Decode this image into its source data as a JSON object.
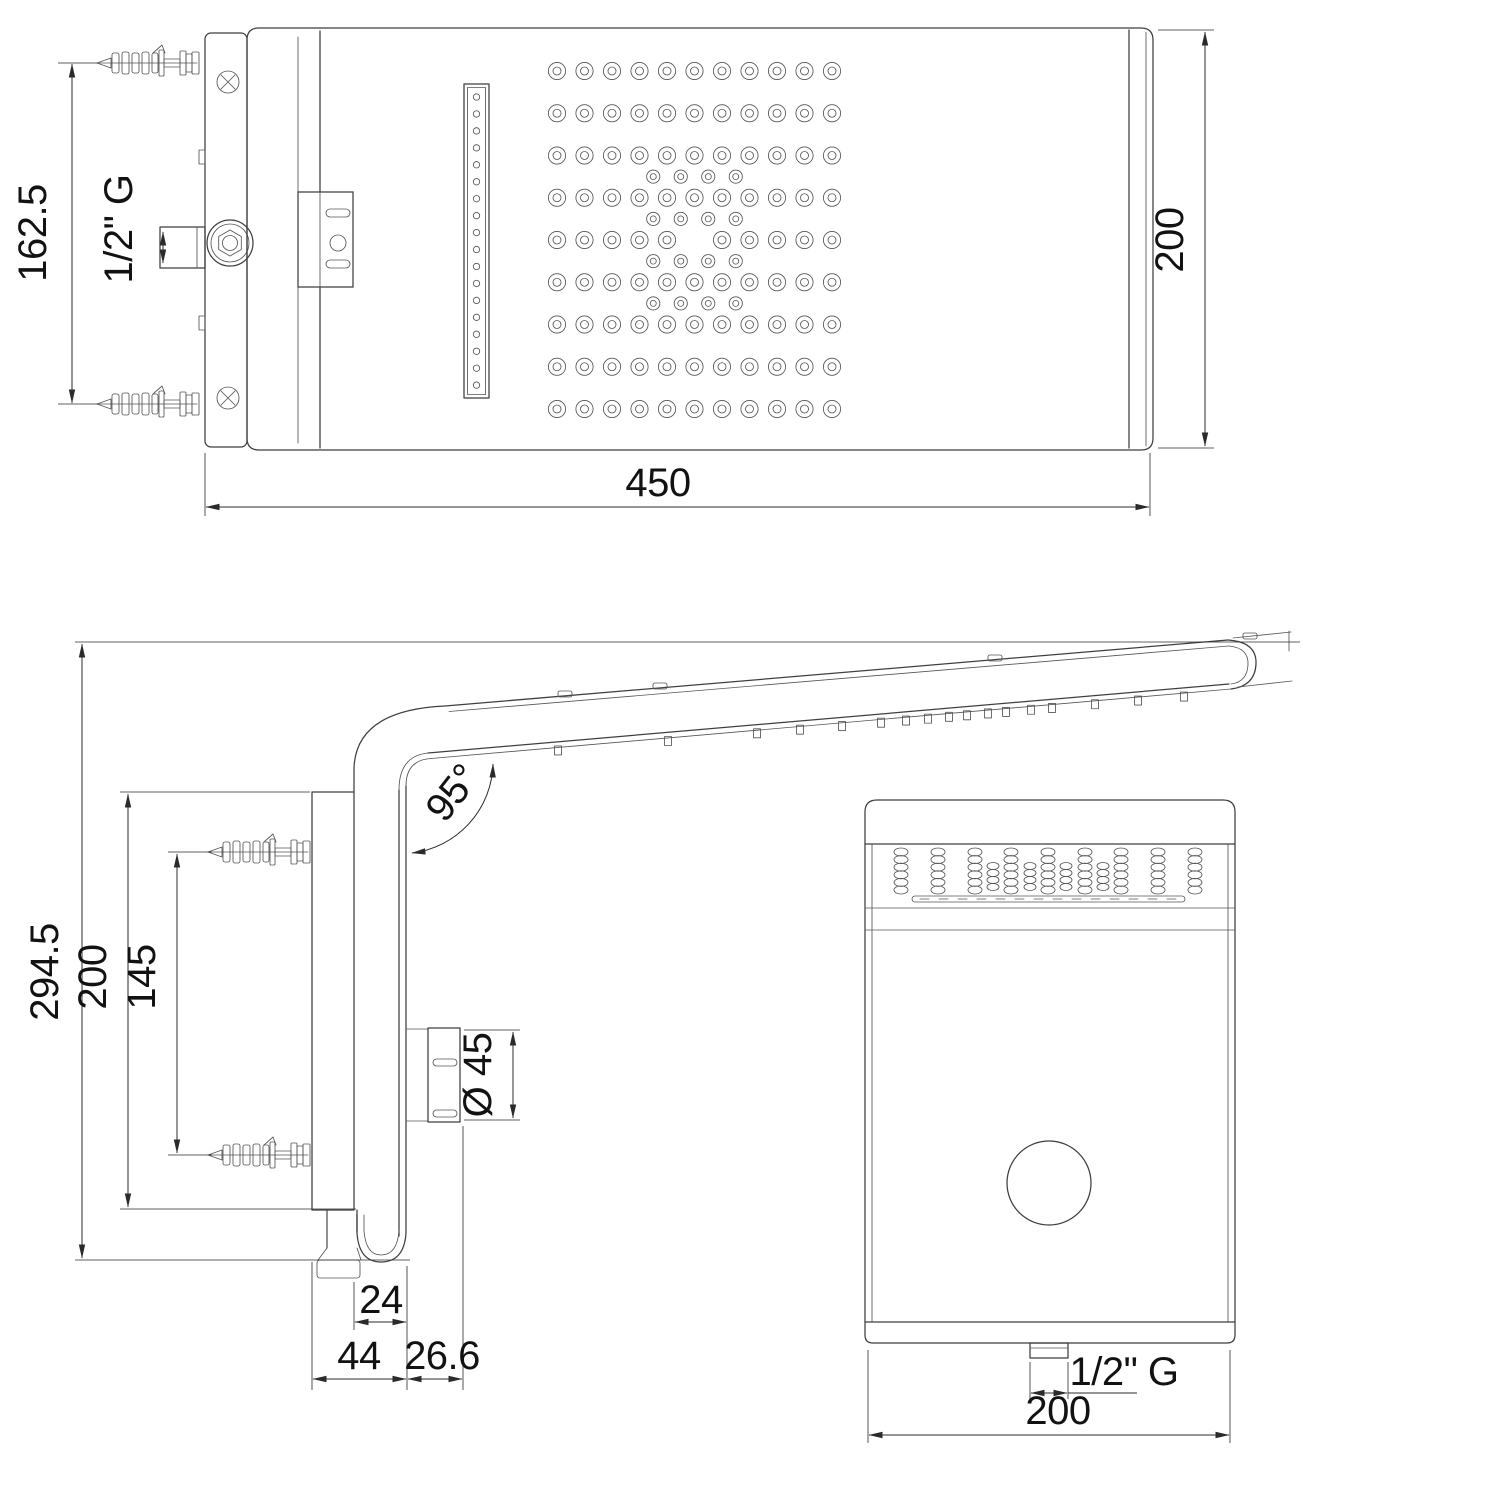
{
  "drawing": {
    "title": "shower-head-technical-drawing",
    "top_view": {
      "dim_width": "450",
      "dim_depth": "200",
      "dim_screw_spacing": "162.5",
      "dim_inlet_thread": "1/2\" G"
    },
    "side_view": {
      "dim_total_height": "294.5",
      "dim_bracket_height": "200",
      "dim_screw_spacing": "145",
      "dim_arm_angle": "95°",
      "dim_connector_diameter": "Ø 45",
      "dim_drain_offset": "24",
      "dim_wall_to_duct": "44",
      "dim_duct_to_connector": "26.6"
    },
    "front_view": {
      "dim_width": "200",
      "dim_outlet_thread": "1/2\" G"
    }
  }
}
